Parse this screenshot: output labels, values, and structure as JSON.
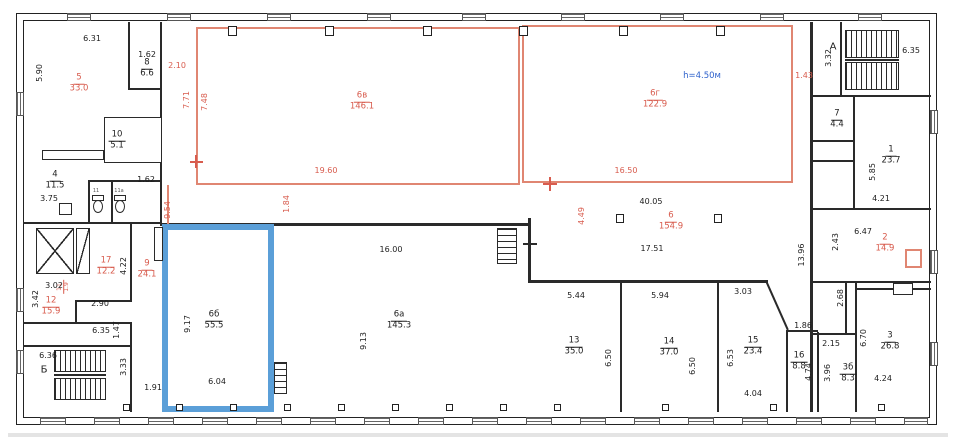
{
  "plan_type": "building-floor-plan",
  "annotations": {
    "height_note": "h=4.50м"
  },
  "stairs": {
    "a": "А",
    "b": "Б"
  },
  "wc": {
    "left": "11",
    "right": "11а"
  },
  "colors": {
    "wall": "#2a2a2a",
    "red_partition": "#e08672",
    "red_text": "#d85c4e",
    "highlight_room": "#5b9fd8",
    "note_blue": "#2f62cc"
  },
  "rooms": {
    "r5": {
      "number": "5",
      "area": "33.0"
    },
    "r8": {
      "number": "8",
      "area": "6.6"
    },
    "r10": {
      "number": "10",
      "area": "5.1"
    },
    "r4": {
      "number": "4",
      "area": "11.5"
    },
    "r17": {
      "number": "17",
      "area": "12.2"
    },
    "r9": {
      "number": "9",
      "area": "24.1"
    },
    "r12": {
      "number": "12",
      "area": "15.9"
    },
    "r11": {
      "number": "11",
      "area": "1.9"
    },
    "r6b": {
      "number": "6б",
      "area": "55.5"
    },
    "r6a": {
      "number": "6а",
      "area": "145.3"
    },
    "r6v": {
      "number": "6в",
      "area": "146.1"
    },
    "r6g": {
      "number": "6г",
      "area": "122.9"
    },
    "r6": {
      "number": "6",
      "area": "154.9"
    },
    "r13": {
      "number": "13",
      "area": "35.0"
    },
    "r14": {
      "number": "14",
      "area": "37.0"
    },
    "r15": {
      "number": "15",
      "area": "23.4"
    },
    "r16": {
      "number": "16",
      "area": "8.8"
    },
    "r3b": {
      "number": "3б",
      "area": "8.3"
    },
    "r3": {
      "number": "3",
      "area": "26.8"
    },
    "r1": {
      "number": "1",
      "area": "23.7"
    },
    "r7": {
      "number": "7",
      "area": "4.4"
    },
    "r2": {
      "number": "2",
      "area": "14.9"
    }
  },
  "dims": {
    "d631": "6.31",
    "d590": "5.90",
    "d162a": "1.62",
    "d210": "2.10",
    "d771": "7.71",
    "d748": "7.48",
    "d954": "9.54",
    "d162b": "1.62",
    "d375": "3.75",
    "d1960": "19.60",
    "d184": "1.84",
    "d1650": "16.50",
    "d143": "1.43",
    "d4005": "40.05",
    "d449": "4.49",
    "d1751": "17.51",
    "d422": "4.22",
    "d290": "2.90",
    "d302": "3.02",
    "d342": "3.42",
    "d635a": "6.35",
    "d147": "1.47",
    "d636": "6.36",
    "d333": "3.33",
    "d191": "1.91",
    "d917": "9.17",
    "d604": "6.04",
    "d1600": "16.00",
    "d913": "9.13",
    "d544": "5.44",
    "d594": "5.94",
    "d303": "3.03",
    "d650a": "6.50",
    "d650b": "6.50",
    "d653": "6.53",
    "d404": "4.04",
    "d186": "1.86",
    "d474": "4.74",
    "d215": "2.15",
    "d396": "3.96",
    "d424": "4.24",
    "d670": "6.70",
    "d332": "3.32",
    "d635b": "6.35",
    "d421": "4.21",
    "d585": "5.85",
    "d647": "6.47",
    "d243": "2.43",
    "d1396": "13.96",
    "d268": "2.68"
  }
}
